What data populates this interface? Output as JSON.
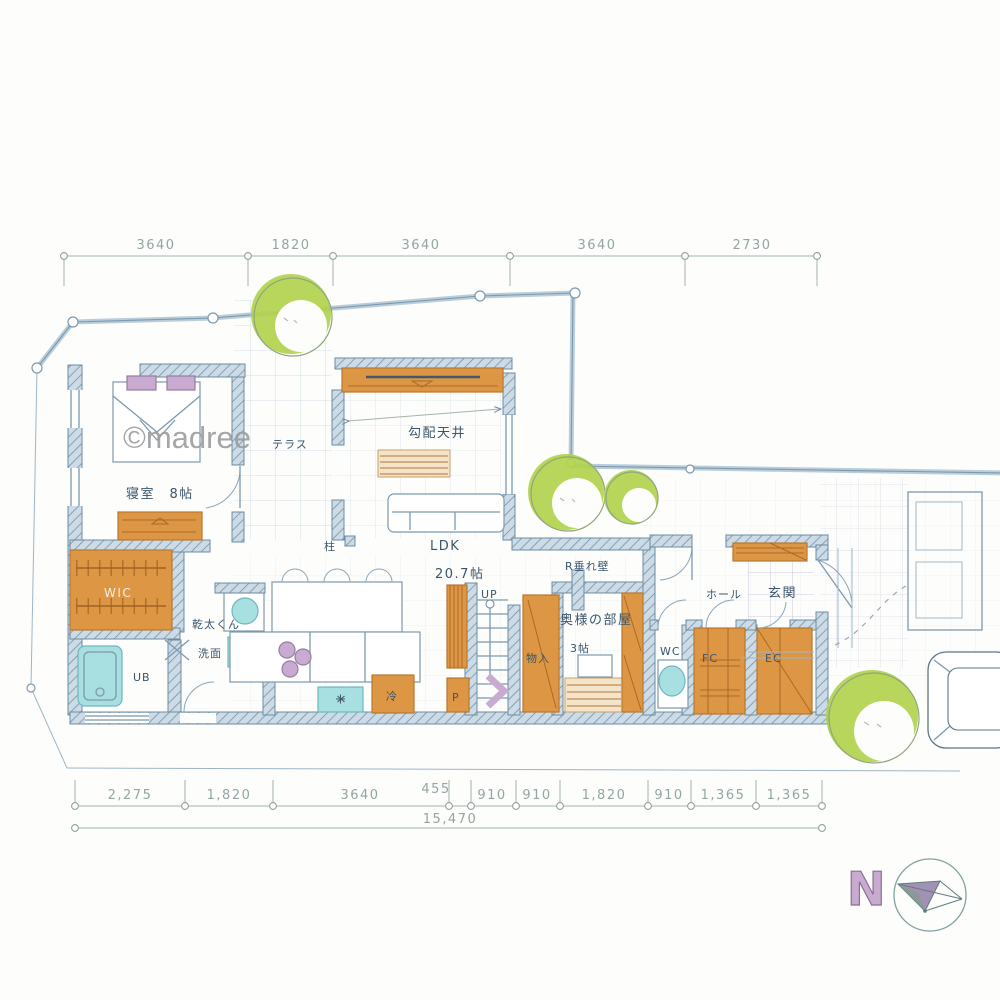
{
  "watermark": {
    "text": "©madree"
  },
  "dimensions": {
    "top": [
      "3640",
      "1820",
      "3640",
      "3640",
      "2730"
    ],
    "bottom": [
      "2,275",
      "1,820",
      "3640",
      "455",
      "910",
      "910",
      "1,820",
      "910",
      "1,365",
      "1,365"
    ],
    "total": "15,470"
  },
  "rooms": {
    "bedroom": "寝室　8帖",
    "terrace": "テラス",
    "sloped_ceiling": "勾配天井",
    "ldk": "LDK",
    "ldk_size": "20.7帖",
    "up": "UP",
    "r_wall": "R垂れ壁",
    "wife_room": "奥様の部屋",
    "wife_room_size": "3帖",
    "storage": "物入",
    "wc": "WC",
    "fc": "FC",
    "ec": "EC",
    "hall": "ホール",
    "entrance": "玄関",
    "wic": "WIC",
    "ub": "UB",
    "washroom": "洗面",
    "dryer": "乾太くん",
    "fridge": "冷",
    "pantry": "P",
    "pillar": "柱"
  },
  "compass": {
    "north_label": "N"
  },
  "palette": {
    "wall_blue": "#c7d6e2",
    "line_blue": "#7d99ad",
    "furniture_orange": "#dd9644",
    "tree_green": "#b2d24d",
    "water_cyan": "#a8dfe0",
    "accent_purple": "#c9abd2",
    "dimension_grey": "#93a5a3",
    "label_navy": "#3a556b"
  }
}
